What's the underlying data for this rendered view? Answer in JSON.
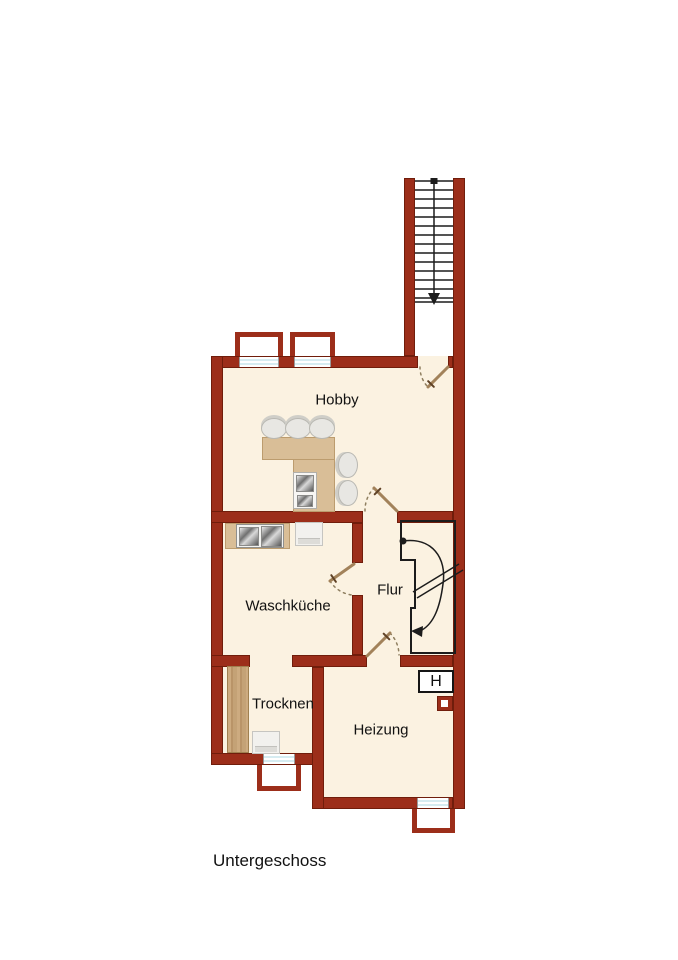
{
  "floor_label": "Untergeschoss",
  "rooms": {
    "hobby": "Hobby",
    "waschkueche": "Waschküche",
    "flur": "Flur",
    "trocknen": "Trocknen",
    "heizung": "Heizung"
  },
  "symbols": {
    "heater": "H"
  },
  "icons": {
    "exterior_stairs_direction": "down-arrow",
    "interior_stairs_direction": "curved-down-arrow"
  },
  "colors": {
    "wall": "#9C2E1A",
    "wall_edge": "#701D0B",
    "floor": "#FBF2E1",
    "furniture": "#D9BE97",
    "furniture_border": "#BC9C6E",
    "wood": "#C8A87D",
    "window": "#D6ECF1",
    "door": "#A2825A",
    "door_handle": "#5F4226",
    "swing": "#8F7F60",
    "stair": "#1C1C1C",
    "label": "#111111"
  }
}
